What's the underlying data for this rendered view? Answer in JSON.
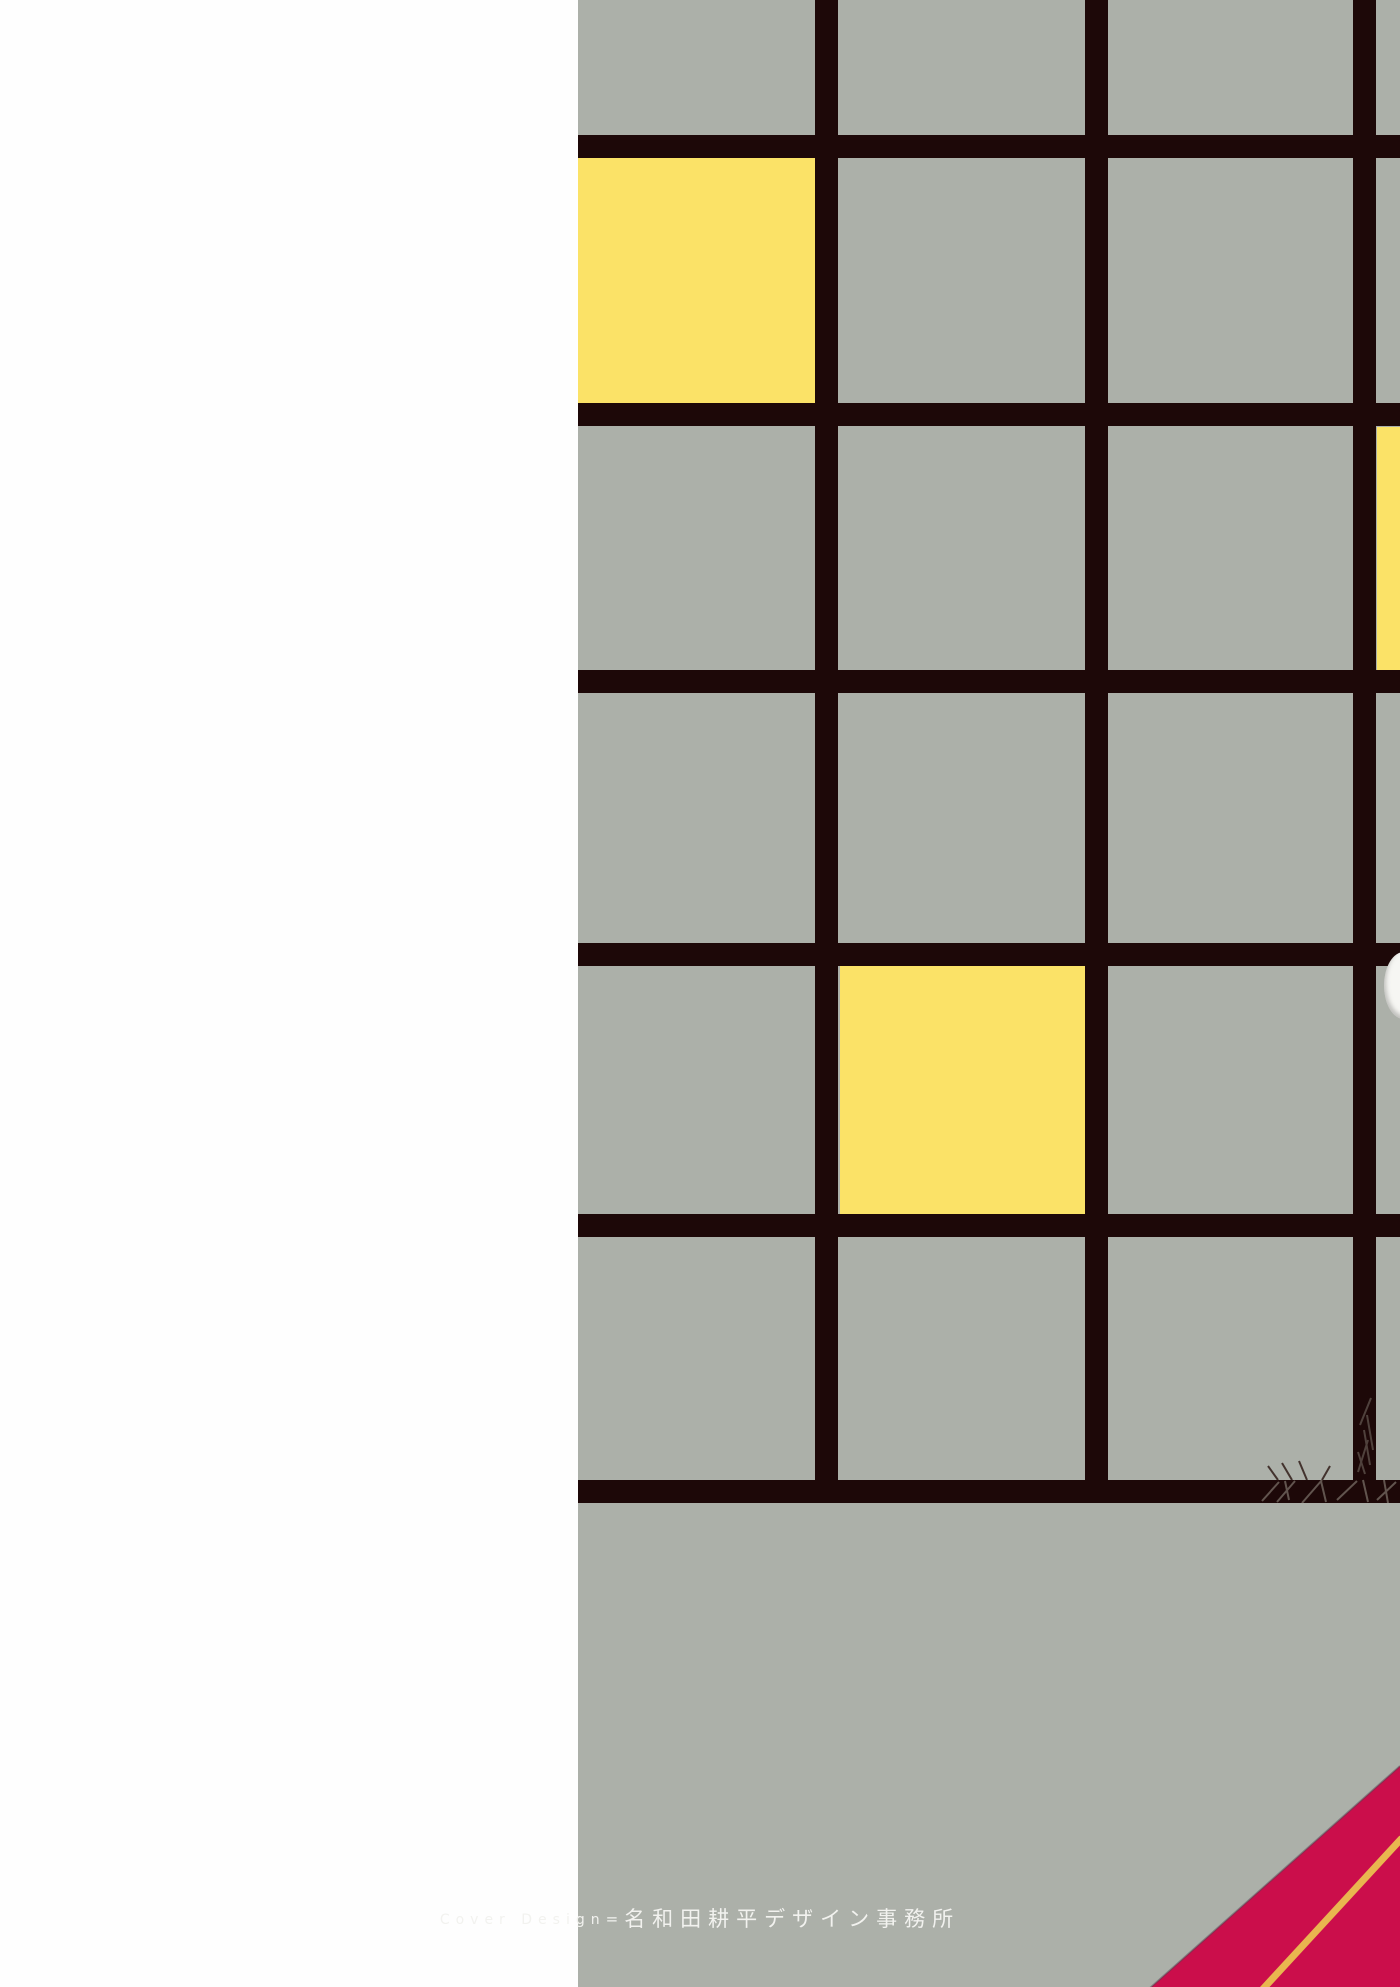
{
  "artwork": {
    "kind": "book back cover scan",
    "style": "mondrian-style grid composition",
    "left_margin": "plain white",
    "grid": {
      "visible_columns": 4,
      "visible_row_bands": 7,
      "line_color_note": "near-black dark brown grid bars",
      "yellow_cells": [
        {
          "col": 1,
          "row": 2,
          "note": "full square, upper left of grid"
        },
        {
          "col": 2,
          "row": 5,
          "note": "full square, middle of grid"
        },
        {
          "col": 4,
          "row": 3,
          "note": "sliver cut off by right image edge"
        }
      ],
      "bottom_band": "solid gray band below last grid line"
    },
    "details": {
      "white_oval": "small white oval partially visible at right edge below fourth horizontal line",
      "scratch_texture": "hand-drawn scratch marks over the bottom-right grid line junction",
      "ribbon": "crimson diagonal corner ribbon at bottom right with a gold diagonal stripe"
    }
  },
  "palette": {
    "page_white": "#FEFEFE",
    "panel_gray": "#ACB0A9",
    "grid_line": "#1D0808",
    "accent_yellow": "#FBE267",
    "ribbon_red": "#CB0E4B",
    "stripe_gold": "#E9B64F",
    "text_white": "#F2F2EF"
  },
  "credit": {
    "label_en": "Cover Design",
    "separator": "=",
    "label_ja": "名和田耕平デザイン事務所"
  }
}
